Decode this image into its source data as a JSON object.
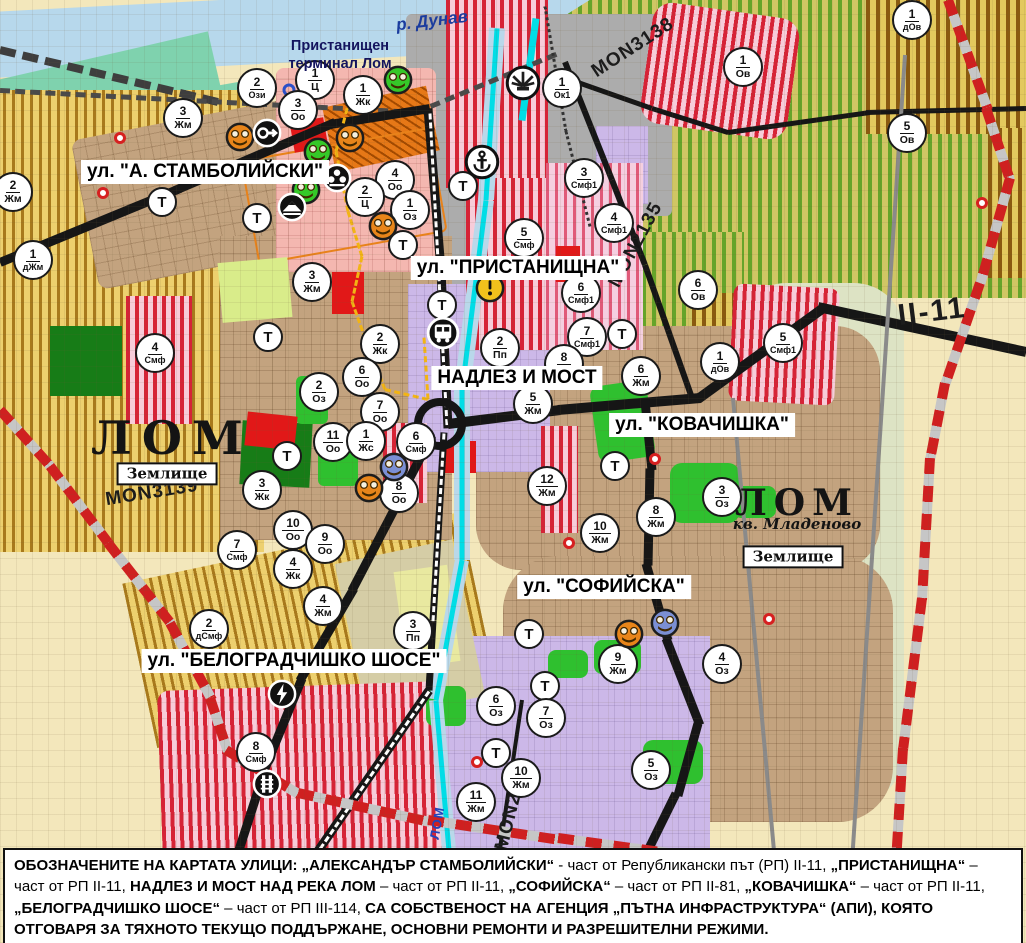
{
  "map": {
    "river_label": {
      "text": "р. Дунав"
    },
    "port_label": {
      "text": "Пристанищен\nтерминал Лом"
    },
    "city_label": {
      "text": "ЛОМ"
    },
    "mladenovo_label": {
      "text": "ЛОМ"
    },
    "kvartal_label": {
      "text": "кв. Младеново"
    },
    "zemlishte_boxes": [
      {
        "line1": "Землище",
        "line2": "44238",
        "x": 167,
        "y": 474
      },
      {
        "line1": "Землище",
        "line2": "44238",
        "x": 793,
        "y": 557
      }
    ],
    "street_labels": [
      {
        "text": "ул. \"А. СТАМБОЛИЙСКИ\"",
        "x": 205,
        "y": 172
      },
      {
        "text": "ул. \"ПРИСТАНИЩНА\"",
        "x": 518,
        "y": 268
      },
      {
        "text": "НАДЛЕЗ И МОСТ",
        "x": 517,
        "y": 378
      },
      {
        "text": "ул. \"КОВАЧИШКА\"",
        "x": 702,
        "y": 425
      },
      {
        "text": "ул. \"СОФИЙСКА\"",
        "x": 604,
        "y": 587
      },
      {
        "text": "ул. \"БЕЛОГРАДЧИШКО ШОСЕ\"",
        "x": 294,
        "y": 661
      }
    ],
    "road_labels": [
      {
        "text": "MON3138",
        "x": 633,
        "y": 48,
        "rot": -33
      },
      {
        "text": "MON2135",
        "x": 636,
        "y": 245,
        "rot": -62
      },
      {
        "text": "MON3139",
        "x": 152,
        "y": 493,
        "rot": -9
      },
      {
        "text": "MON2136",
        "x": 513,
        "y": 805,
        "rot": -76
      },
      {
        "text": "II-11",
        "x": 932,
        "y": 312,
        "rot": -7,
        "big": true
      },
      {
        "text": "ЛОМ",
        "x": 437,
        "y": 823,
        "rot": -80,
        "river": true
      }
    ],
    "zone_markers": [
      {
        "num": "2",
        "code": "Ози",
        "x": 257,
        "y": 88
      },
      {
        "num": "1",
        "code": "Ц",
        "x": 315,
        "y": 80
      },
      {
        "num": "1",
        "code": "Жк",
        "x": 363,
        "y": 95
      },
      {
        "num": "3",
        "code": "Оо",
        "x": 298,
        "y": 110
      },
      {
        "num": "3",
        "code": "Жм",
        "x": 183,
        "y": 118
      },
      {
        "num": "1",
        "code": "Ок1",
        "x": 562,
        "y": 88
      },
      {
        "num": "2",
        "code": "Жм",
        "x": 13,
        "y": 192
      },
      {
        "num": "1",
        "code": "дЖм",
        "x": 33,
        "y": 260
      },
      {
        "num": "4",
        "code": "Оо",
        "x": 395,
        "y": 180
      },
      {
        "num": "2",
        "code": "Ц",
        "x": 365,
        "y": 197
      },
      {
        "num": "1",
        "code": "Оз",
        "x": 410,
        "y": 210
      },
      {
        "num": "3",
        "code": "Жм",
        "x": 312,
        "y": 282
      },
      {
        "num": "3",
        "code": "Смф1",
        "x": 584,
        "y": 178
      },
      {
        "num": "4",
        "code": "Смф1",
        "x": 614,
        "y": 223
      },
      {
        "num": "5",
        "code": "Смф",
        "x": 524,
        "y": 238
      },
      {
        "num": "6",
        "code": "Смф1",
        "x": 581,
        "y": 293
      },
      {
        "num": "7",
        "code": "Смф1",
        "x": 587,
        "y": 337
      },
      {
        "num": "2",
        "code": "Пп",
        "x": 500,
        "y": 348
      },
      {
        "num": "8",
        "code": "Жм",
        "x": 564,
        "y": 364
      },
      {
        "num": "5",
        "code": "Жм",
        "x": 533,
        "y": 404
      },
      {
        "num": "6",
        "code": "Жм",
        "x": 641,
        "y": 376
      },
      {
        "num": "12",
        "code": "Жм",
        "x": 547,
        "y": 486
      },
      {
        "num": "10",
        "code": "Жм",
        "x": 600,
        "y": 533
      },
      {
        "num": "8",
        "code": "Жм",
        "x": 656,
        "y": 517
      },
      {
        "num": "3",
        "code": "Оз",
        "x": 722,
        "y": 497
      },
      {
        "num": "6",
        "code": "Ов",
        "x": 698,
        "y": 290
      },
      {
        "num": "1",
        "code": "Ов",
        "x": 743,
        "y": 67
      },
      {
        "num": "5",
        "code": "Ов",
        "x": 907,
        "y": 133
      },
      {
        "num": "1",
        "code": "дОв",
        "x": 912,
        "y": 20
      },
      {
        "num": "1",
        "code": "дОв",
        "x": 720,
        "y": 362
      },
      {
        "num": "5",
        "code": "Смф1",
        "x": 783,
        "y": 343
      },
      {
        "num": "2",
        "code": "Жк",
        "x": 380,
        "y": 344
      },
      {
        "num": "6",
        "code": "Оо",
        "x": 362,
        "y": 377
      },
      {
        "num": "2",
        "code": "Оз",
        "x": 319,
        "y": 392
      },
      {
        "num": "7",
        "code": "Оо",
        "x": 380,
        "y": 412
      },
      {
        "num": "11",
        "code": "Оо",
        "x": 333,
        "y": 442
      },
      {
        "num": "1",
        "code": "Жс",
        "x": 366,
        "y": 441
      },
      {
        "num": "6",
        "code": "Смф",
        "x": 416,
        "y": 442
      },
      {
        "num": "8",
        "code": "Оо",
        "x": 399,
        "y": 493
      },
      {
        "num": "3",
        "code": "Жк",
        "x": 262,
        "y": 490
      },
      {
        "num": "10",
        "code": "Оо",
        "x": 293,
        "y": 530
      },
      {
        "num": "9",
        "code": "Оо",
        "x": 325,
        "y": 544
      },
      {
        "num": "7",
        "code": "Смф",
        "x": 237,
        "y": 550
      },
      {
        "num": "4",
        "code": "Жк",
        "x": 293,
        "y": 569
      },
      {
        "num": "4",
        "code": "Жм",
        "x": 323,
        "y": 606
      },
      {
        "num": "2",
        "code": "дСмф",
        "x": 209,
        "y": 629
      },
      {
        "num": "3",
        "code": "Пп",
        "x": 413,
        "y": 631
      },
      {
        "num": "8",
        "code": "Смф",
        "x": 256,
        "y": 752
      },
      {
        "num": "4",
        "code": "Смф",
        "x": 155,
        "y": 353
      },
      {
        "num": "9",
        "code": "Жм",
        "x": 618,
        "y": 664
      },
      {
        "num": "4",
        "code": "Оз",
        "x": 722,
        "y": 664
      },
      {
        "num": "6",
        "code": "Оз",
        "x": 496,
        "y": 706
      },
      {
        "num": "7",
        "code": "Оз",
        "x": 546,
        "y": 718
      },
      {
        "num": "5",
        "code": "Оз",
        "x": 651,
        "y": 770
      },
      {
        "num": "10",
        "code": "Жм",
        "x": 521,
        "y": 778
      },
      {
        "num": "11",
        "code": "Жм",
        "x": 476,
        "y": 802
      }
    ],
    "t_markers": [
      [
        162,
        202
      ],
      [
        257,
        218
      ],
      [
        268,
        337
      ],
      [
        287,
        456
      ],
      [
        463,
        186
      ],
      [
        403,
        245
      ],
      [
        442,
        305
      ],
      [
        622,
        334
      ],
      [
        615,
        466
      ],
      [
        529,
        634
      ],
      [
        545,
        686
      ],
      [
        496,
        753
      ]
    ],
    "icon_markers": [
      {
        "type": "monument",
        "color": "orange",
        "x": 240,
        "y": 137
      },
      {
        "type": "monument",
        "color": "orange",
        "x": 350,
        "y": 138
      },
      {
        "type": "monument",
        "color": "orange",
        "x": 383,
        "y": 226
      },
      {
        "type": "monument",
        "color": "orange",
        "x": 369,
        "y": 488
      },
      {
        "type": "monument",
        "color": "orange",
        "x": 629,
        "y": 634
      },
      {
        "type": "monument",
        "color": "green",
        "x": 398,
        "y": 80
      },
      {
        "type": "monument",
        "color": "green",
        "x": 318,
        "y": 152
      },
      {
        "type": "monument",
        "color": "green",
        "x": 306,
        "y": 190
      },
      {
        "type": "monument",
        "color": "blue",
        "x": 394,
        "y": 467
      },
      {
        "type": "monument",
        "color": "blue",
        "x": 665,
        "y": 623
      },
      {
        "type": "key",
        "x": 267,
        "y": 133
      },
      {
        "type": "people",
        "x": 337,
        "y": 178
      },
      {
        "type": "mountain",
        "x": 292,
        "y": 207
      },
      {
        "type": "anchor",
        "x": 482,
        "y": 162
      },
      {
        "type": "fan",
        "x": 523,
        "y": 83
      },
      {
        "type": "bus",
        "x": 443,
        "y": 333
      },
      {
        "type": "warning",
        "x": 490,
        "y": 288
      },
      {
        "type": "lightning",
        "x": 282,
        "y": 694
      },
      {
        "type": "rails",
        "x": 267,
        "y": 784
      }
    ],
    "red_dots": [
      [
        120,
        138
      ],
      [
        103,
        193
      ],
      [
        655,
        459
      ],
      [
        569,
        543
      ],
      [
        477,
        762
      ],
      [
        769,
        619
      ],
      [
        982,
        203
      ]
    ],
    "blue_rings": [
      [
        289,
        90
      ]
    ]
  },
  "caption": {
    "segments": [
      {
        "text": "ОБОЗНАЧЕНИТЕ НА КАРТАТА УЛИЦИ: „АЛЕКСАНДЪР СТАМБОЛИЙСКИ“",
        "bold": true
      },
      {
        "text": " - част от Републикански път (РП) II-11, ",
        "bold": false
      },
      {
        "text": "„ПРИСТАНИЩНА“",
        "bold": true
      },
      {
        "text": " – част от РП II-11, ",
        "bold": false
      },
      {
        "text": "НАДЛЕЗ И МОСТ НАД РЕКА ЛОМ",
        "bold": true
      },
      {
        "text": " – част от РП II-11, ",
        "bold": false
      },
      {
        "text": "„СОФИЙСКА“",
        "bold": true
      },
      {
        "text": " – част от РП II-81, ",
        "bold": false
      },
      {
        "text": "„КОВАЧИШКА“",
        "bold": true
      },
      {
        "text": " – част от РП II-11, ",
        "bold": false
      },
      {
        "text": "„БЕЛОГРАДЧИШКО ШОСЕ“",
        "bold": true
      },
      {
        "text": " – част от РП III-114, ",
        "bold": false
      },
      {
        "text": "СА СОБСТВЕНОСТ НА АГЕНЦИЯ „ПЪТНА ИНФРАСТРУКТУРА“ (АПИ), КОЯТО ОТГОВАРЯ ЗА ТЯХНОТО ТЕКУЩО ПОДДЪРЖАНЕ, ОСНОВНИ РЕМОНТИ И РАЗРЕШИТЕЛНИ РЕЖИМИ.",
        "bold": true
      }
    ]
  },
  "colors": {
    "road_black": "#161616",
    "river_blue": "#b7d8ec",
    "canal_cyan": "#00dde6",
    "residential_brown": "#c3a37f",
    "mixed_red_stripe": "#d62336",
    "industrial_purple": "#ccb8e8",
    "vineyard_green": "#64a82b",
    "agri_yellow": "#edd06e",
    "park_green": "#2fc02f",
    "monument_orange": "#e8851a",
    "monument_green": "#35c828",
    "monument_blue": "#7b8fd4",
    "warning_yellow": "#f2c11c",
    "boundary_red_dash": "#cf2020"
  }
}
